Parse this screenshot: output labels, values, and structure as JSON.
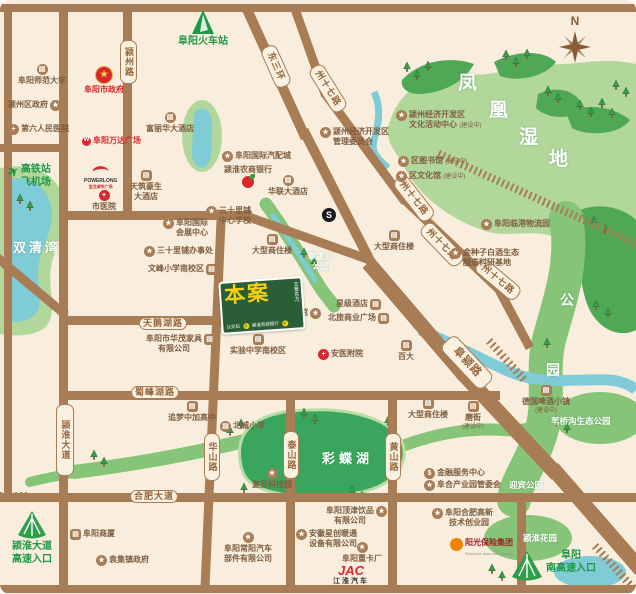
{
  "compass": {
    "n": "N"
  },
  "icons": {
    "star": "★",
    "cross": "+",
    "building": "▤",
    "money": "$",
    "plane": "✈",
    "s_mark": "S",
    "gov_star": "★",
    "w_mark": "W",
    "bus": "B",
    "yuan": "¥"
  },
  "colors": {
    "road": "#a87c54",
    "background": "#f9eedd",
    "park_green": "#86c478",
    "wetland_green": "#b2d79b",
    "lake_green": "#3aa55c",
    "water_teal": "#7fcbd6",
    "accent_red": "#d7282f",
    "accent_green": "#1f9747",
    "project_green": "#2a5e36",
    "project_yellow": "#f5d011"
  },
  "roads": {
    "yingzhou": "颍州路",
    "dongsanhuan": "东三环",
    "zhou17": "州十七路",
    "fuying": "阜颍路",
    "tianehu": "天鹅湖路",
    "shufenghu": "蜀峰湖路",
    "yinghuai_ave": "颍淮大道",
    "hefei_ave": "合肥大道",
    "huashan": "华山路",
    "taishan": "泰山路",
    "huangshan": "黄山路"
  },
  "areas": {
    "fh": [
      "凤",
      "凰",
      "湿",
      "地"
    ],
    "shuangqingwan": "双清湾",
    "caidiehu": "彩蝶湖",
    "gong": "公",
    "yuan": "园",
    "fuyinghe1": "阜颍河",
    "fuyinghe2": "公园",
    "weiqiaogou": "苇桥沟生态公园",
    "yingbin": "迎宾公园",
    "yinghuai_garden": "颍淮花园"
  },
  "suffix_uc": "(建设中)",
  "pois": {
    "normal_univ": "阜阳师范大学",
    "yz_gov": "颍州区政府",
    "sixth_hosp": "第六人民医院",
    "fy_gov": "阜阳市政府",
    "wanda": "阜阳万达广场",
    "powerlong": "POWERLONG",
    "powerlong_cn": "宝龙城市广场",
    "city_hosp": "市医院",
    "tianzhu1": "天筑豪生",
    "tianzhu2": "大酒店",
    "gaotie1": "高铁站",
    "gaotie2": "飞机场",
    "train_station": "阜阳火车站",
    "fulihua": "富丽华大酒店",
    "qipei": "阜阳国际汽配城",
    "nongshang": "颍淮农商银行",
    "hualian": "华联大酒店",
    "kfq1": "颍州经济开发区",
    "kfq2": "管理委员会",
    "whzx1": "颍州经济开发区",
    "whzx2": "文化活动中心",
    "lib": "区图书馆",
    "whg": "区文化馆",
    "linggang": "阜阳临港物流园",
    "jzz1": "金种子白酒生态",
    "jzz2": "酿造科研基地",
    "sslp1": "三十里铺",
    "sslp2": "中心学校",
    "huizhan1": "阜阳国际",
    "huizhan2": "会展中心",
    "sslp_office": "三十里铺办事处",
    "wenfeng": "文峰小学南校区",
    "dxszl": "大型商住楼",
    "haiyang": "海洋馆",
    "xingji": "星级酒店",
    "beilv": "北旅商业广场",
    "huamao1": "阜阳市华茂家具",
    "huamao2": "有限公司",
    "shiyan": "实验中学南校区",
    "anyi": "安医附院",
    "baida": "百大",
    "zhuimeng": "追梦中加高中",
    "beicheng": "北城小学",
    "fudan": "复旦科技园",
    "jinrong": "金融服务中心",
    "fuhe": "阜合产业园管委会",
    "chuangye1": "阜阳合肥高新",
    "chuangye2": "技术创业园",
    "sunshine": "阳光保险集团",
    "sunshine_en": "Sunshine Insurance Group",
    "dingjin1": "阜阳顶津饮品",
    "dingjin2": "有限公司",
    "xingchuang1": "安徽星创暖通",
    "xingchuang2": "设备有限公司",
    "changyang1": "阜阳常阳汽车",
    "changyang2": "部件有限公司",
    "zhongka": "阜阳重卡厂",
    "jac": "JAC",
    "jac_cn": "江淮汽车",
    "shangsha": "阜阳商厦",
    "yuanji": "袁集镇政府",
    "mojie": "磨街",
    "deguo": "德国啤酒小镇",
    "entr_sw1": "颍淮大道",
    "entr_sw2": "高速入口",
    "entr_s1": "阜阳",
    "entr_s2": "南高速入口"
  },
  "project": {
    "name": "本案",
    "side": "文景东方",
    "bus": "公交站",
    "bank": "颍淮农商银行"
  }
}
